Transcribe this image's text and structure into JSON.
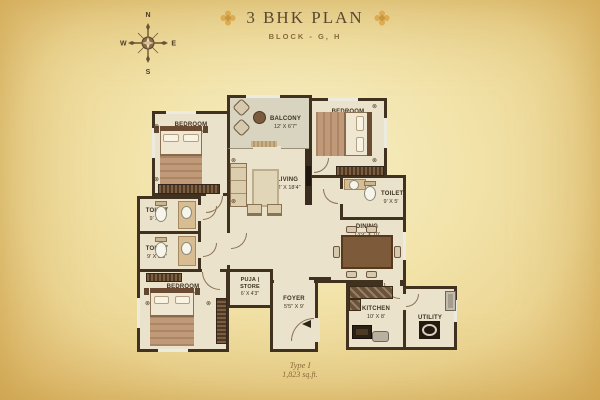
{
  "header": {
    "title": "3 BHK PLAN",
    "subtitle": "BLOCK - G, H"
  },
  "compass": {
    "n": "N",
    "e": "E",
    "s": "S",
    "w": "W"
  },
  "rooms": {
    "bedroom_tl": {
      "name": "BEDROOM",
      "dim": "10'6\" X 12'"
    },
    "bedroom_tr": {
      "name": "BEDROOM",
      "dim": "10'6\" X 12'"
    },
    "bedroom_bl": {
      "name": "BEDROOM",
      "dim": "13' X 10'6\""
    },
    "balcony": {
      "name": "BALCONY",
      "dim": "12' X 6'7\""
    },
    "living": {
      "name": "LIVING",
      "dim": "12' X 18'4\""
    },
    "toilet_l1": {
      "name": "TOILET",
      "dim": "9' X 5'"
    },
    "toilet_l2": {
      "name": "TOILET",
      "dim": "9' X 5'5\""
    },
    "toilet_r": {
      "name": "TOILET",
      "dim": "9' X 5'"
    },
    "dining": {
      "name": "DINING",
      "dim": "13'9\" X 10'"
    },
    "puja": {
      "name": "PUJA | STORE",
      "dim": "6' X 4'3\""
    },
    "foyer": {
      "name": "FOYER",
      "dim": "5'5\" X 9'"
    },
    "kitchen": {
      "name": "KITCHEN",
      "dim": "10' X 8'"
    },
    "utility": {
      "name": "UTILITY",
      "dim": "5' X 8'"
    }
  },
  "footer": {
    "type_label": "Type I",
    "area_label": "1,823 sq.ft."
  },
  "icons": {
    "column_marker": "⊗"
  },
  "colors": {
    "wall": "#41321f",
    "floor": "#ebe2cc",
    "balcony_floor": "#d8d4bf",
    "accent_gold": "#d9a94e",
    "title_text": "#5a4730"
  }
}
